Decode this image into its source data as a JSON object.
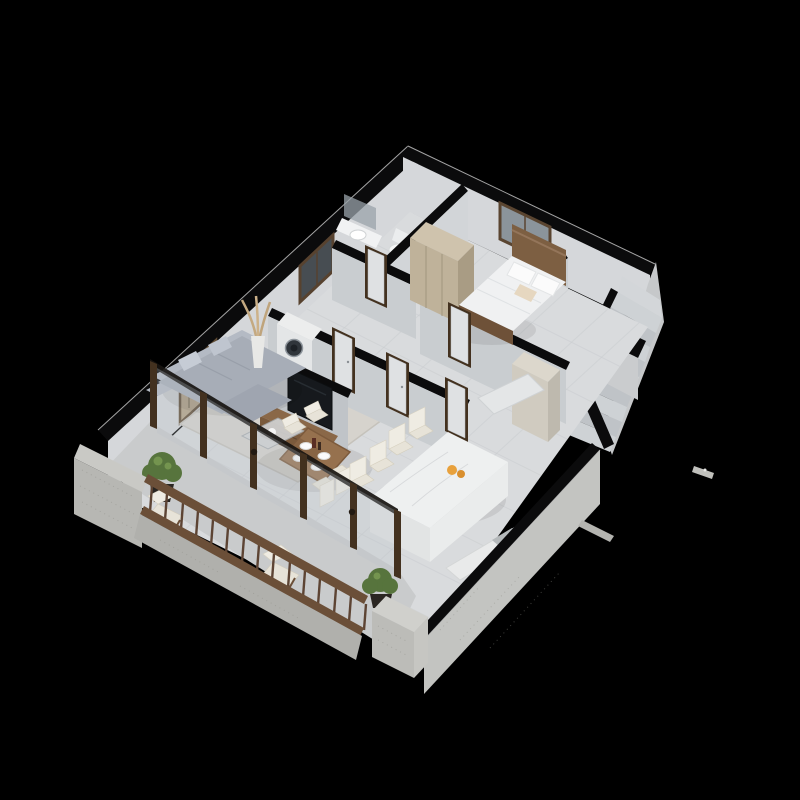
{
  "scene": {
    "type": "3d-isometric-floor-plan-render",
    "description": "Cutaway axonometric render of a one-bedroom apartment with balcony and staircase, walls sectioned in black, on a black background",
    "visible_text": "none"
  },
  "palette": {
    "background": "#000000",
    "wall_cut": "#0b0b0c",
    "wall_face": "#d5d7da",
    "wall_face_shade": "#c9cdd0",
    "floor": "#d9dbdd",
    "floor_line": "#c8cbce",
    "rug": "#d6d3cd",
    "balcony_floor": "#c9cbcc",
    "stone": "#b7b7b3",
    "wood": "#8a6848",
    "wood_dark": "#6e5138",
    "door_frame_wood": "#43311f",
    "sofa": "#a7adb7",
    "cream_fabric": "#e7e3d8",
    "bedding_white": "#f0f1f2",
    "marble": "#eef0f0",
    "tv_screen": "#16191d",
    "plant_green": "#57743d",
    "fruit_accent": "#e8a13c",
    "glass": "#b9c3c8"
  },
  "rooms": {
    "living_room": {
      "items": [
        "gray-sectional-sofa",
        "throw-pillows",
        "area-rug",
        "glass-coffee-table",
        "wood-tv-console",
        "flat-screen-tv",
        "abstract-wall-art",
        "pampas-vase-plant",
        "window"
      ]
    },
    "dining_area": {
      "items": [
        "wood-dining-table",
        "cream-chairs-x4",
        "place-settings-x4",
        "dark-bottles"
      ]
    },
    "kitchen": {
      "items": [
        "marble-island",
        "bar-stools-x4",
        "fruit-bowl",
        "wall-counter",
        "sink",
        "cooktop",
        "tall-cabinet",
        "entry-mat"
      ]
    },
    "bedroom": {
      "items": [
        "double-bed",
        "wood-headboard",
        "white-duvet",
        "pillows",
        "beige-cushion",
        "wardrobe",
        "window"
      ]
    },
    "bathroom": {
      "items": [
        "vanity-sink",
        "mirror",
        "toilet"
      ]
    },
    "laundry": {
      "items": [
        "washing-machine"
      ]
    },
    "hallway": {
      "items": [
        "door-x3",
        "bedroom-door",
        "bathroom-door",
        "transom-window"
      ]
    },
    "staircase": {
      "items": [
        "steps-x9",
        "landing",
        "black-parapet",
        "mid-block"
      ]
    },
    "balcony": {
      "items": [
        "wood-railing-with-spindles",
        "stone-parapet",
        "stone-column",
        "lounge-chairs-x2",
        "potted-shrubs-x2",
        "sliding-door-frames",
        "wall-lamps"
      ]
    }
  },
  "artifacts": {
    "items": [
      "stray-render-fragment-right",
      "stray-render-fragment-lower"
    ]
  }
}
